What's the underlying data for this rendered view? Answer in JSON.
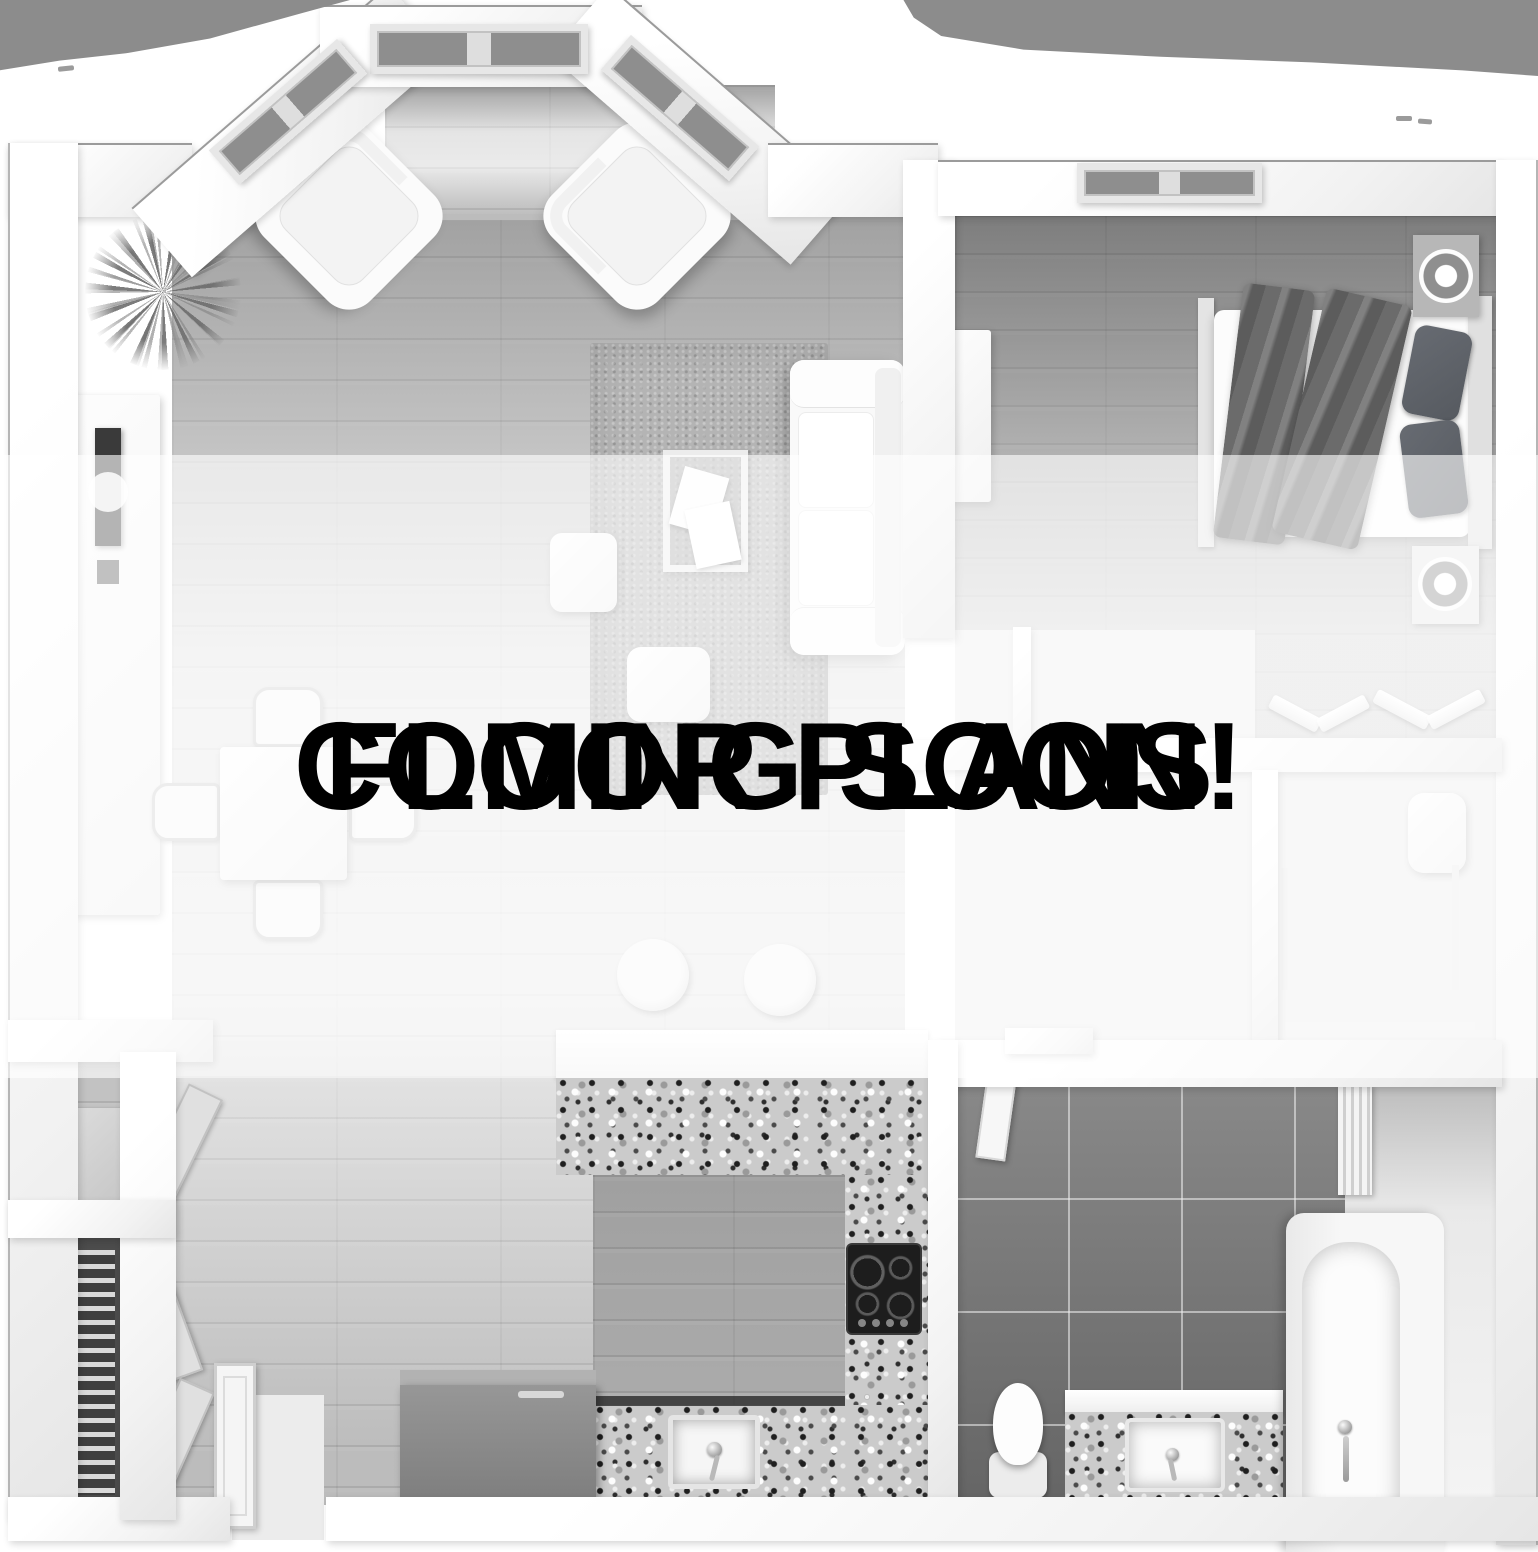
{
  "overlay": {
    "line1": "FLOOR PLANS",
    "line2": "COMING SOON!",
    "band_color": "rgba(255,255,255,0.62)",
    "text_color": "#000000"
  },
  "palette": {
    "background": "#ffffff",
    "outside_mask_gray": "#8c8c8c",
    "wall_white": "#f6f6f6",
    "living_wood_floor": "#c9c9c9",
    "bedroom_wood_floor": "#aaaaaa",
    "bathroom_tile": "#7b7b7b",
    "granite_base": "#cbcbcb",
    "appliance_gray": "#8a8a8a",
    "blanket_gray": "#6b6b6b"
  }
}
